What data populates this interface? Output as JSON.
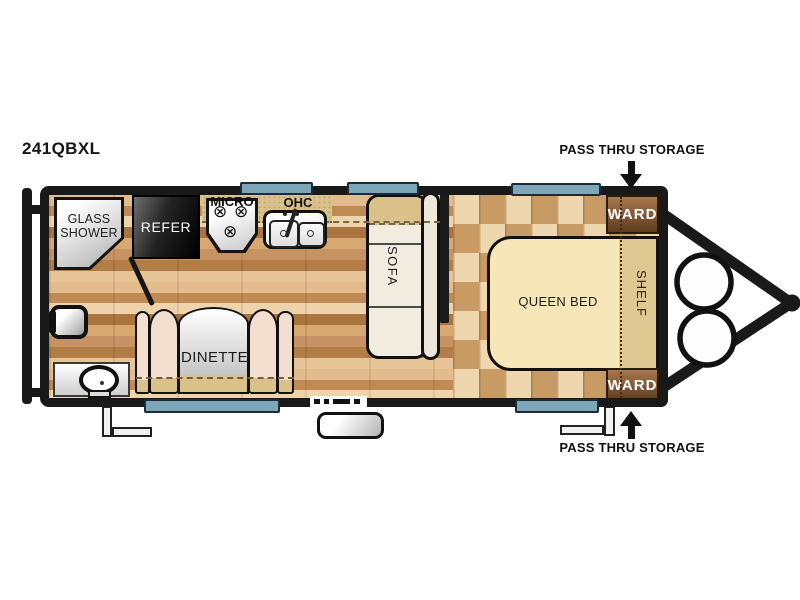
{
  "title": {
    "model": "241QBXL"
  },
  "annotations": {
    "pass_thru_top": "PASS THRU STORAGE",
    "pass_thru_bottom": "PASS THRU STORAGE"
  },
  "fixtures": {
    "shower_line1": "GLASS",
    "shower_line2": "SHOWER",
    "refrigerator": "REFER",
    "microwave": "MICRO",
    "overhead_cabinet": "OHC",
    "sofa": "SOFA",
    "dinette": "DINETTE",
    "queen_bed": "QUEEN BED",
    "shelf": "SHELF",
    "wardrobe_top": "WARD",
    "wardrobe_bottom": "WARD"
  },
  "icons": {
    "burner_glyph": "⊗"
  },
  "palette": {
    "wall": "#191919",
    "window_blue": "#7ea6b9",
    "counter_khaki": "#d9c189",
    "bed_cream": "#f6e6b8",
    "shelf_tan": "#e0c893",
    "ward_brown": "#8a5c34",
    "cushion": "#f3ded0",
    "floor_light": "#e7c498",
    "floor_dark": "#a9743e"
  }
}
